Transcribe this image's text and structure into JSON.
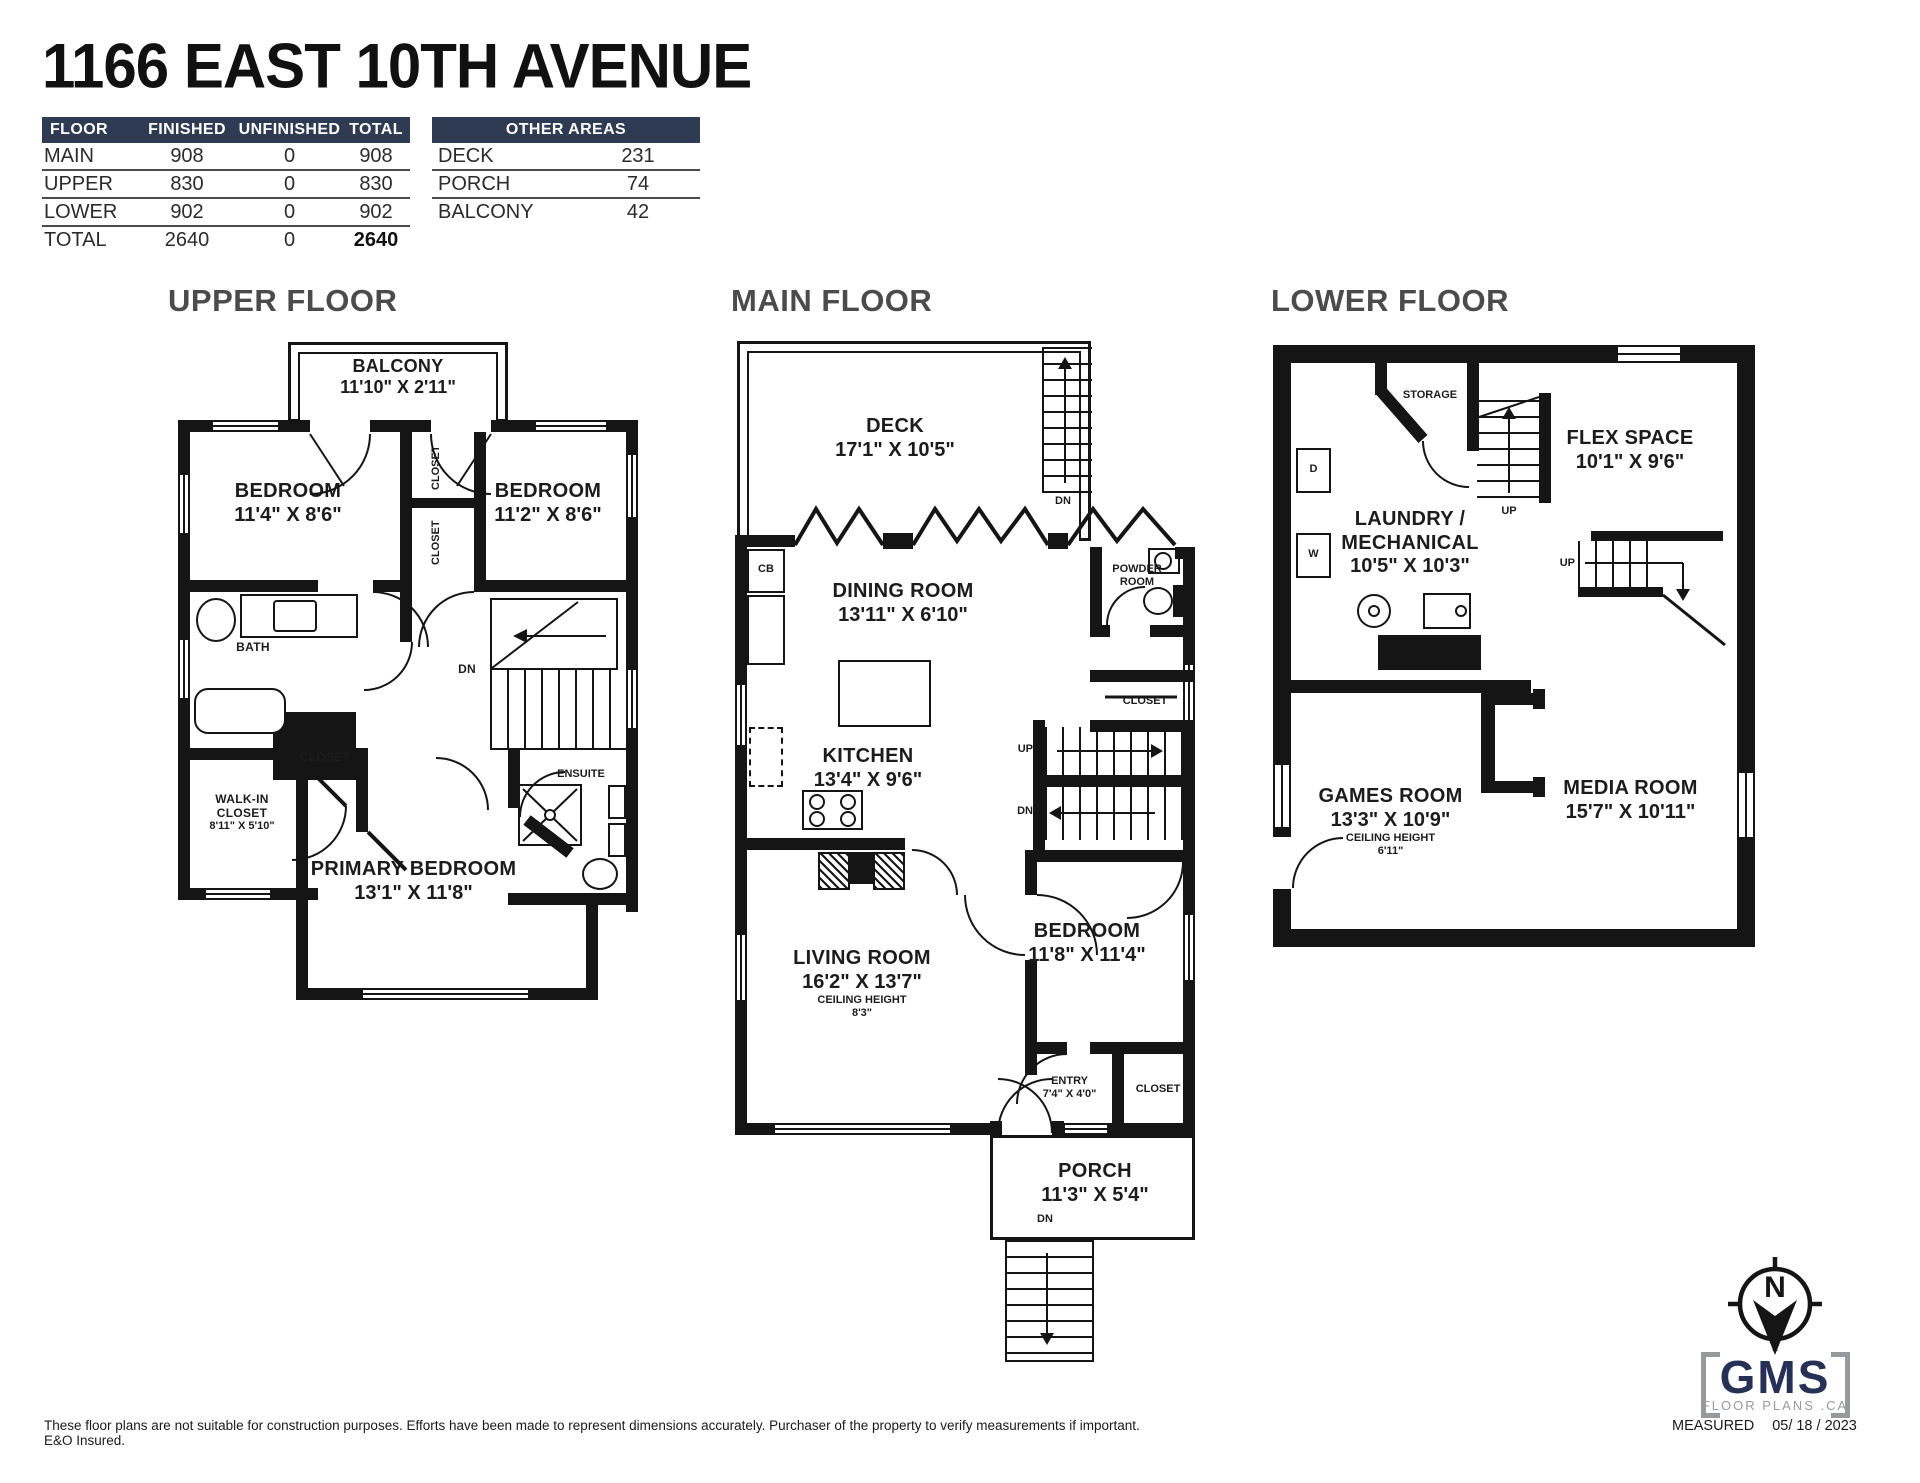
{
  "title": "1166 EAST 10TH AVENUE",
  "tables": {
    "floor": {
      "headers": [
        "FLOOR",
        "FINISHED",
        "UNFINISHED",
        "TOTAL"
      ],
      "rows": [
        [
          "MAIN",
          "908",
          "0",
          "908"
        ],
        [
          "UPPER",
          "830",
          "0",
          "830"
        ],
        [
          "LOWER",
          "902",
          "0",
          "902"
        ],
        [
          "TOTAL",
          "2640",
          "0",
          "2640"
        ]
      ]
    },
    "other": {
      "header": "OTHER AREAS",
      "rows": [
        [
          "DECK",
          "231"
        ],
        [
          "PORCH",
          "74"
        ],
        [
          "BALCONY",
          "42"
        ]
      ]
    }
  },
  "sections": {
    "upper": "UPPER FLOOR",
    "main": "MAIN FLOOR",
    "lower": "LOWER FLOOR"
  },
  "upper": {
    "balcony": {
      "name": "BALCONY",
      "dims": "11'10\" X 2'11\""
    },
    "bedroom_left": {
      "name": "BEDROOM",
      "dims": "11'4\" X 8'6\""
    },
    "bedroom_right": {
      "name": "BEDROOM",
      "dims": "11'2\" X 8'6\""
    },
    "closet_top": "CLOSET",
    "closet_mid": "CLOSET",
    "bath": "BATH",
    "dn": "DN",
    "closet_small": "CLOSET",
    "walkin": {
      "line1": "WALK-IN",
      "line2": "CLOSET",
      "dims": "8'11\" X 5'10\""
    },
    "ensuite": "ENSUITE",
    "primary": {
      "name": "PRIMARY BEDROOM",
      "dims": "13'1\" X 11'8\""
    }
  },
  "main": {
    "deck": {
      "name": "DECK",
      "dims": "17'1\" X 10'5\""
    },
    "dn_deck": "DN",
    "cb": "CB",
    "dining": {
      "name": "DINING ROOM",
      "dims": "13'11\" X 6'10\""
    },
    "powder": {
      "line1": "POWDER",
      "line2": "ROOM"
    },
    "kitchen": {
      "name": "KITCHEN",
      "dims": "13'4\" X 9'6\""
    },
    "closet_right": "CLOSET",
    "up": "UP",
    "dn": "DN",
    "living": {
      "name": "LIVING ROOM",
      "dims": "16'2\" X 13'7\"",
      "ch_label": "CEILING HEIGHT",
      "ch": "8'3\""
    },
    "bedroom": {
      "name": "BEDROOM",
      "dims": "11'8\" X 11'4\""
    },
    "entry": {
      "name": "ENTRY",
      "dims": "7'4\" X 4'0\""
    },
    "closet_entry": "CLOSET",
    "porch": {
      "name": "PORCH",
      "dims": "11'3\" X 5'4\""
    },
    "dn_porch": "DN"
  },
  "lower": {
    "storage": "STORAGE",
    "up_center": "UP",
    "flex": {
      "name": "FLEX SPACE",
      "dims": "10'1\" X 9'6\""
    },
    "dryer": "D",
    "washer": "W",
    "laundry": {
      "line1": "LAUNDRY /",
      "line2": "MECHANICAL",
      "dims": "10'5\" X 10'3\""
    },
    "up_right": "UP",
    "games": {
      "name": "GAMES ROOM",
      "dims": "13'3\" X 10'9\"",
      "ch_label": "CEILING HEIGHT",
      "ch": "6'11\""
    },
    "media": {
      "name": "MEDIA ROOM",
      "dims": "15'7\" X 10'11\""
    }
  },
  "footer": {
    "disclaimer": "These floor plans are not suitable for construction purposes. Efforts have been made to represent dimensions accurately.  Purchaser of the property to verify measurements if important.  E&O Insured.",
    "measured_label": "MEASURED",
    "measured_date": "05/ 18 / 2023",
    "logo": {
      "name": "GMS",
      "sub": "FLOOR PLANS .CA",
      "north": "N"
    }
  },
  "colors": {
    "header_bg": "#2e3b52",
    "wall": "#151515",
    "section_gray": "#4b4b4b",
    "logo_navy": "#273156",
    "logo_gray": "#97999c"
  }
}
